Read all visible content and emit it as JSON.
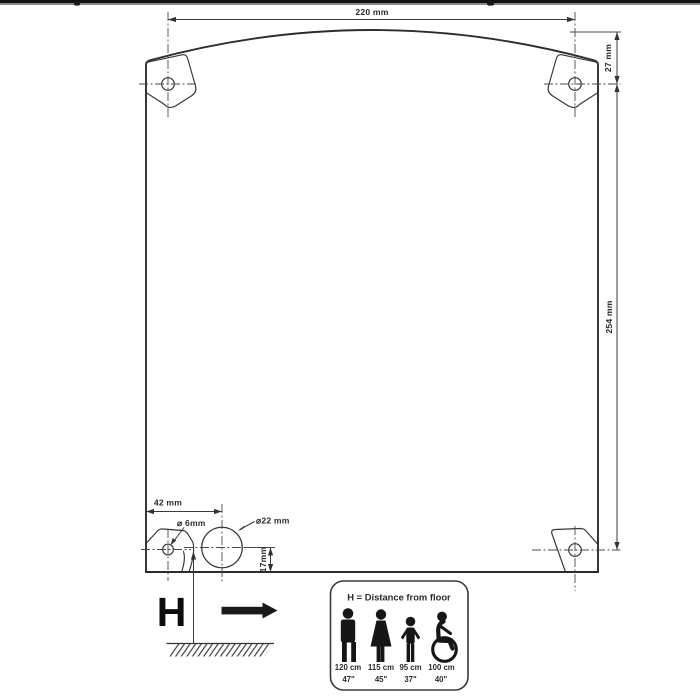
{
  "drawing": {
    "dim_width_top": "220 mm",
    "dim_top_offset": "27 mm",
    "dim_side_height": "254 mm",
    "dim_hole_offset": "42 mm",
    "dim_small_hole": "⌀ 6mm",
    "dim_large_hole": "⌀22 mm",
    "dim_bottom_offset": "17mm",
    "height_symbol": "H"
  },
  "legend": {
    "title": "H = Distance from floor",
    "entries": [
      {
        "figure": "man",
        "height_cm": "120 cm",
        "height_in": "47\""
      },
      {
        "figure": "woman",
        "height_cm": "115 cm",
        "height_in": "45\""
      },
      {
        "figure": "child",
        "height_cm": "95 cm",
        "height_in": "37\""
      },
      {
        "figure": "wheelchair",
        "height_cm": "100 cm",
        "height_in": "40\""
      }
    ]
  }
}
